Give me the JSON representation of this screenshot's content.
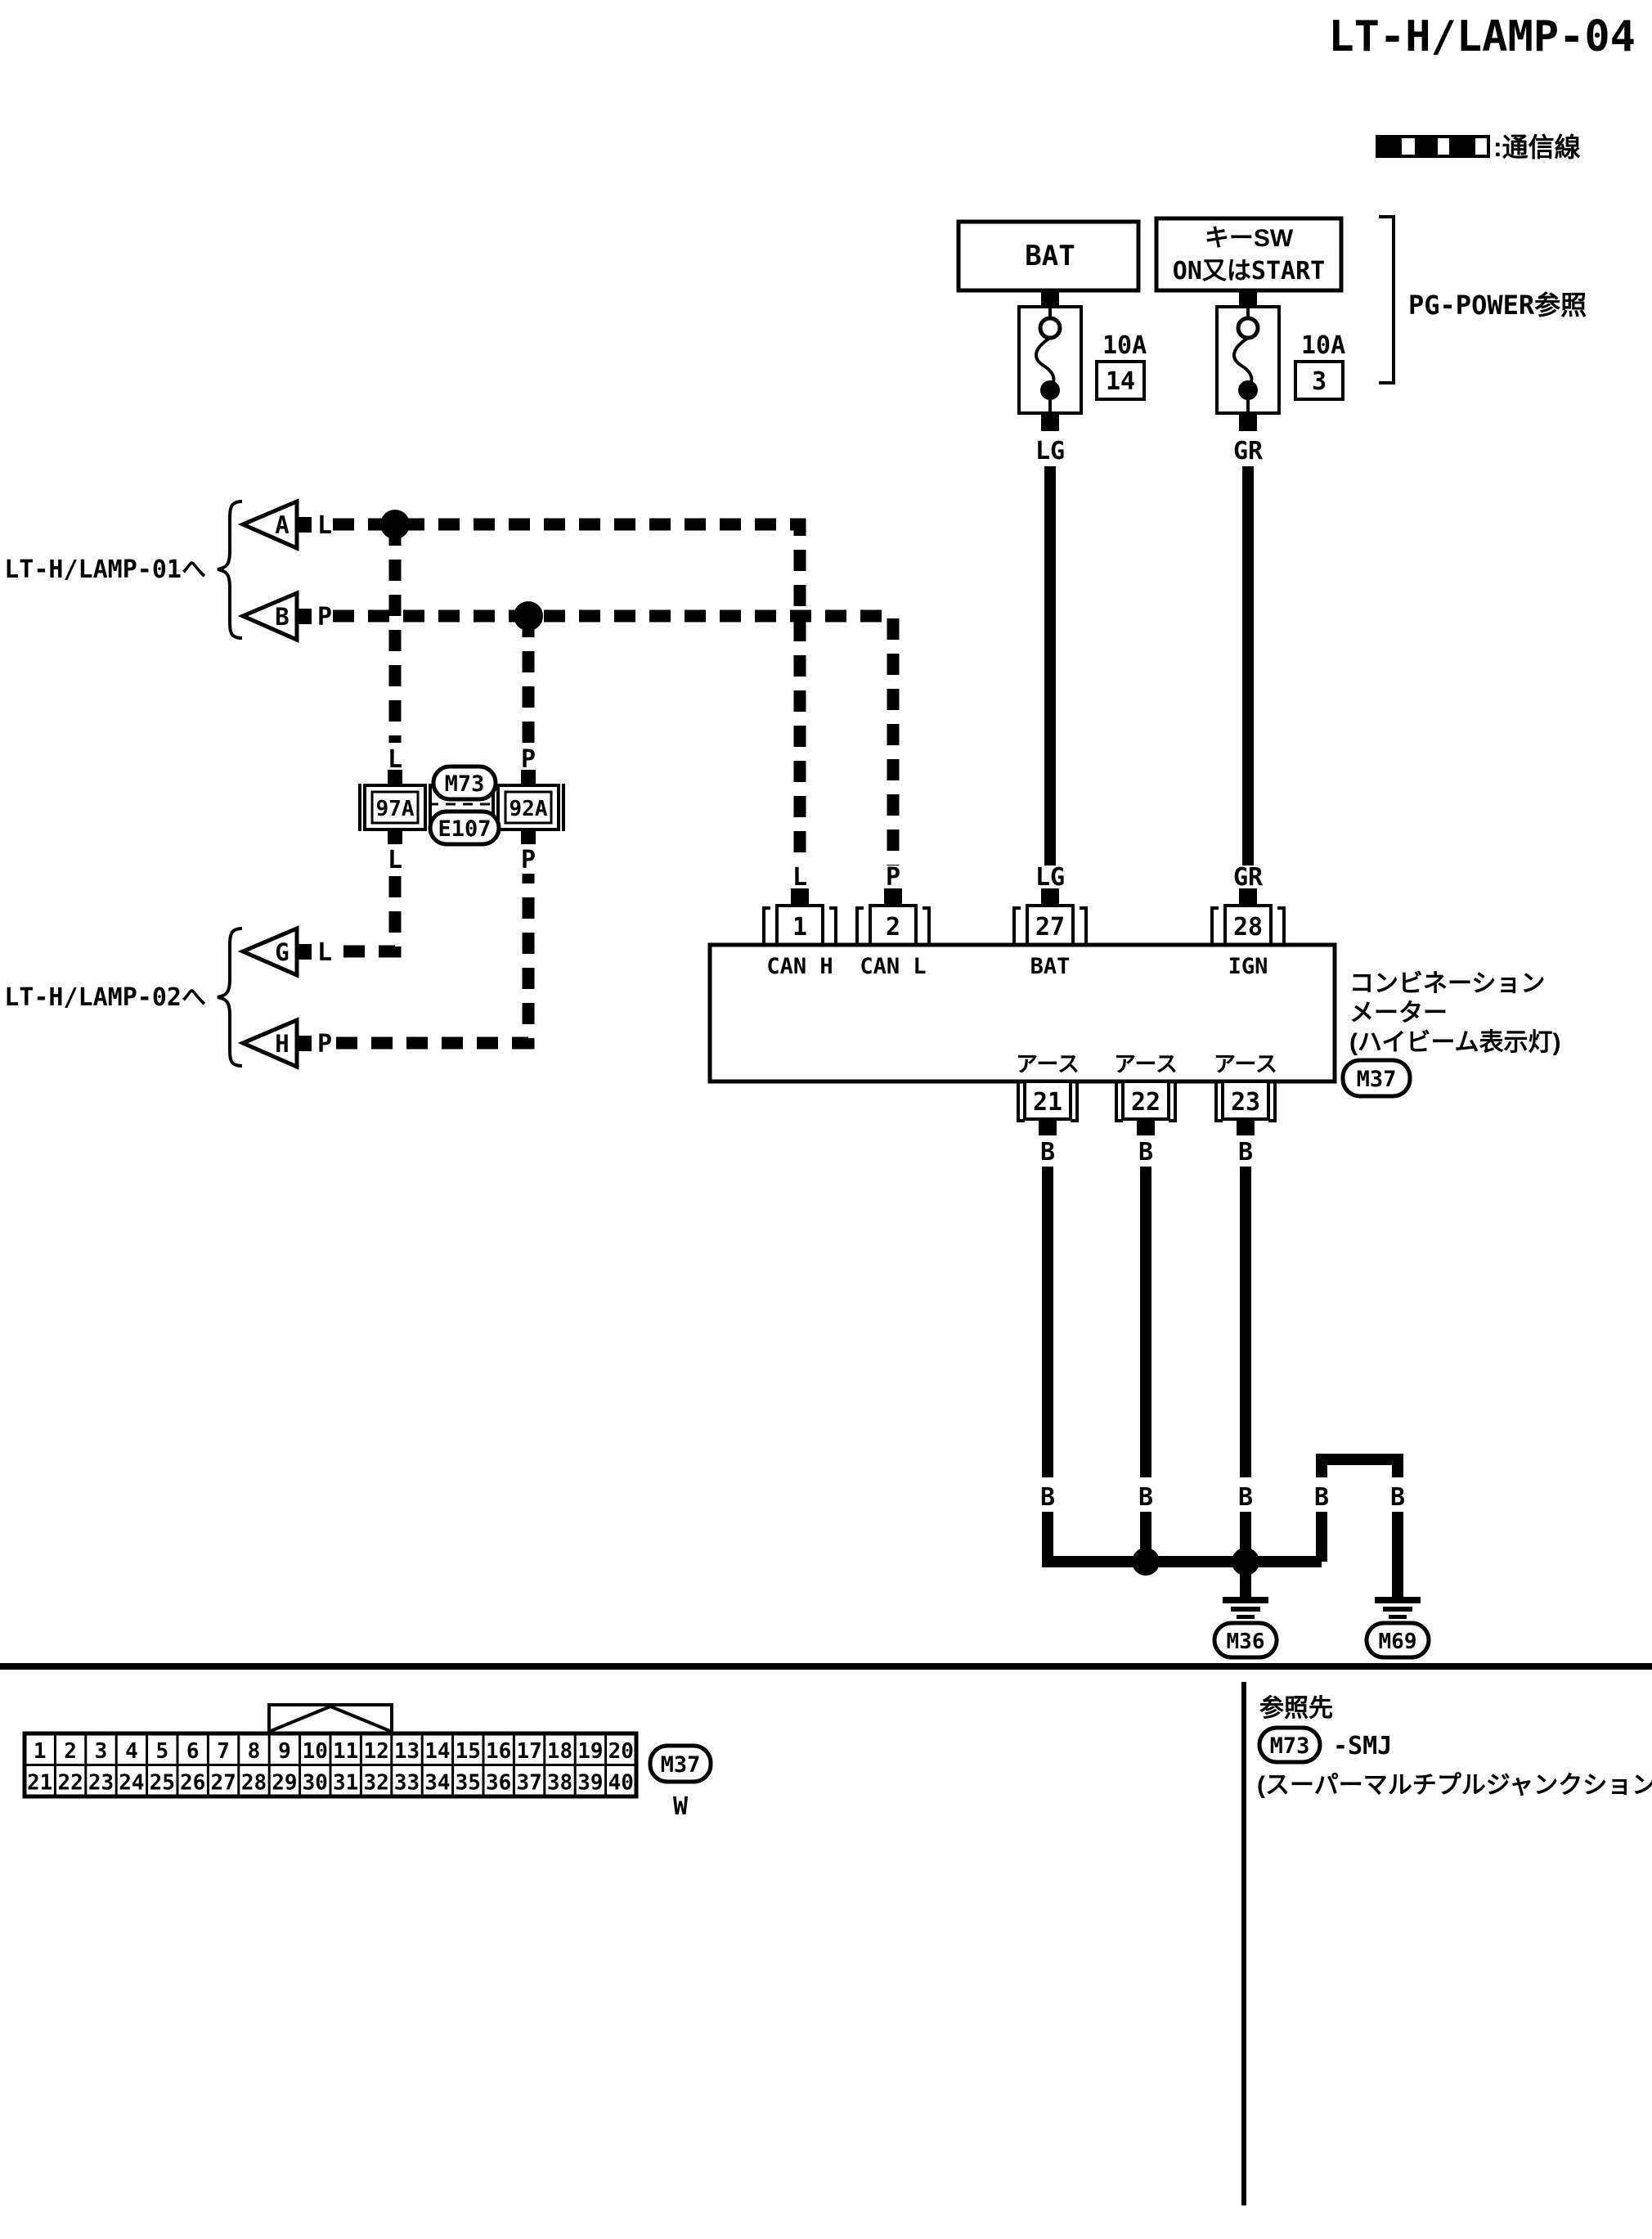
{
  "title": "LT-H/LAMP-04",
  "colors": {
    "line": "#000000",
    "background": "#ffffff"
  },
  "legend": {
    "label": ":通信線"
  },
  "power": {
    "bat_box": "BAT",
    "key_sw_line1": "キーSW",
    "key_sw_line2": "ON又はSTART",
    "fuse1": {
      "rating": "10A",
      "number": "14",
      "wire": "LG"
    },
    "fuse2": {
      "rating": "10A",
      "number": "3",
      "wire": "GR"
    },
    "pg_power_ref": "PG-POWER参照"
  },
  "left": {
    "lamp01": "LT-H/LAMP-01へ",
    "lamp02": "LT-H/LAMP-02へ",
    "tri_a": "A",
    "tri_b": "B",
    "tri_g": "G",
    "tri_h": "H",
    "wire_l": "L",
    "wire_p": "P"
  },
  "smj": {
    "m73": "M73",
    "e107": "E107",
    "left_pin": "97A",
    "right_pin": "92A"
  },
  "meter": {
    "pins_top": [
      {
        "num": "1",
        "label": "CAN H",
        "wire": "L"
      },
      {
        "num": "2",
        "label": "CAN L",
        "wire": "P"
      },
      {
        "num": "27",
        "label": "BAT",
        "wire": "LG"
      },
      {
        "num": "28",
        "label": "IGN",
        "wire": "GR"
      }
    ],
    "name1": "コンビネーション",
    "name2": "メーター",
    "name3": "(ハイビーム表示灯)",
    "code": "M37",
    "ground_label": "アース",
    "pins_bottom": [
      "21",
      "22",
      "23"
    ],
    "wire_b": "B"
  },
  "grounds": {
    "g1": "M36",
    "g2": "M69"
  },
  "connector_table": {
    "row1": [
      "1",
      "2",
      "3",
      "4",
      "5",
      "6",
      "7",
      "8",
      "9",
      "10",
      "11",
      "12",
      "13",
      "14",
      "15",
      "16",
      "17",
      "18",
      "19",
      "20"
    ],
    "row2": [
      "21",
      "22",
      "23",
      "24",
      "25",
      "26",
      "27",
      "28",
      "29",
      "30",
      "31",
      "32",
      "33",
      "34",
      "35",
      "36",
      "37",
      "38",
      "39",
      "40"
    ],
    "code": "M37",
    "color": "W"
  },
  "reference": {
    "heading": "参照先",
    "code": "M73",
    "suffix": "-SMJ",
    "note": "(スーパーマルチプルジャンクション)"
  }
}
